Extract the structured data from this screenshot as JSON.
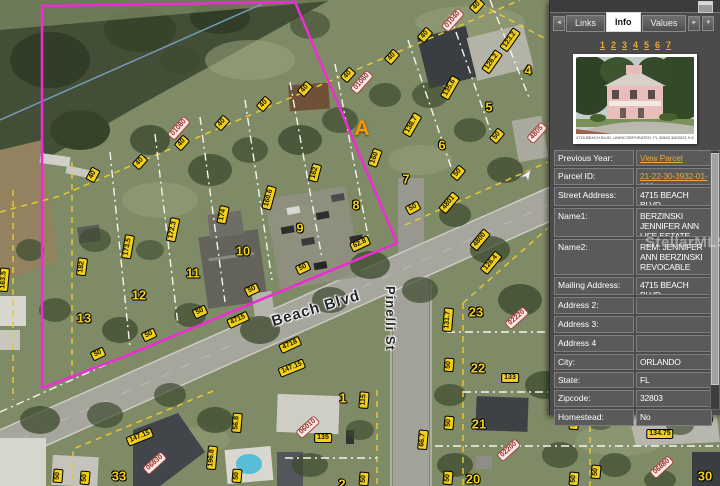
{
  "panel": {
    "tabs": {
      "prev_label": "◄",
      "items": [
        {
          "label": "Links",
          "active": false
        },
        {
          "label": "Info",
          "active": true
        },
        {
          "label": "Values",
          "active": false
        }
      ],
      "next_label": "►",
      "more_label": "▼"
    },
    "pagination": [
      "1",
      "2",
      "3",
      "4",
      "5",
      "6",
      "7"
    ],
    "photo_caption": "4715 BEACH BLVD, UNINCORPORATED, FL 32803   3/8/2021 9:28 AM",
    "fields": [
      {
        "label": "Previous Year:",
        "value": "View Parcel Record",
        "link": true,
        "h": 16
      },
      {
        "label": "Parcel ID:",
        "value": "21-22-30-3932-01-080",
        "link": true,
        "h": 17
      },
      {
        "label": "Street Address:",
        "value": "4715 BEACH BLVD",
        "link": false,
        "h": 19
      },
      {
        "label": "Name1:",
        "value": "BERZINSKI JENNIFER ANN LIFE ESTATE",
        "link": false,
        "h": 29
      },
      {
        "label": "Name2:",
        "value": "REM: JENNIFER ANN BERZINSKI REVOCABLE TRUST",
        "link": false,
        "h": 36
      },
      {
        "label": "Mailing Address:",
        "value": "4715 BEACH BLVD",
        "link": false,
        "h": 18
      },
      {
        "label": "Address 2:",
        "value": "",
        "link": false,
        "h": 17
      },
      {
        "label": "Address 3:",
        "value": "",
        "link": false,
        "h": 17
      },
      {
        "label": "Address 4",
        "value": "",
        "link": false,
        "h": 17
      },
      {
        "label": "City:",
        "value": "ORLANDO",
        "link": false,
        "h": 16
      },
      {
        "label": "State:",
        "value": "FL",
        "link": false,
        "h": 16
      },
      {
        "label": "Zipcode:",
        "value": "32803",
        "link": false,
        "h": 17
      },
      {
        "label": "Homestead:",
        "value": "No",
        "link": false,
        "h": 17
      }
    ]
  },
  "map": {
    "marker": "A",
    "watermark": "StellarMLS",
    "streets": [
      {
        "name": "Beach Blvd"
      },
      {
        "name": "Pinelli St"
      }
    ],
    "colors": {
      "selection": "#ee2bd4",
      "dimension_label": "#f2d018",
      "address_label": "#ffe9e6",
      "link_accent": "#e8a838"
    },
    "parcel_numbers": [
      {
        "t": "1",
        "x": 343,
        "y": 398
      },
      {
        "t": "2",
        "x": 342,
        "y": 484
      },
      {
        "t": "4",
        "x": 528,
        "y": 70
      },
      {
        "t": "5",
        "x": 489,
        "y": 107
      },
      {
        "t": "6",
        "x": 442,
        "y": 145
      },
      {
        "t": "7",
        "x": 406,
        "y": 179
      },
      {
        "t": "8",
        "x": 356,
        "y": 205
      },
      {
        "t": "9",
        "x": 300,
        "y": 228
      },
      {
        "t": "10",
        "x": 243,
        "y": 251
      },
      {
        "t": "11",
        "x": 193,
        "y": 273
      },
      {
        "t": "12",
        "x": 139,
        "y": 295
      },
      {
        "t": "13",
        "x": 84,
        "y": 318
      },
      {
        "t": "20",
        "x": 473,
        "y": 479
      },
      {
        "t": "21",
        "x": 479,
        "y": 424
      },
      {
        "t": "22",
        "x": 478,
        "y": 368
      },
      {
        "t": "23",
        "x": 476,
        "y": 312
      },
      {
        "t": "29",
        "x": 705,
        "y": 419
      },
      {
        "t": "30",
        "x": 705,
        "y": 476
      },
      {
        "t": "33",
        "x": 119,
        "y": 476
      }
    ],
    "dim_labels": [
      {
        "t": "40",
        "x": 93,
        "y": 175,
        "r": -62
      },
      {
        "t": "40",
        "x": 140,
        "y": 162,
        "r": -48
      },
      {
        "t": "40",
        "x": 182,
        "y": 143,
        "r": -48
      },
      {
        "t": "40",
        "x": 222,
        "y": 123,
        "r": -48
      },
      {
        "t": "40",
        "x": 264,
        "y": 104,
        "r": -48
      },
      {
        "t": "40",
        "x": 305,
        "y": 89,
        "r": -48
      },
      {
        "t": "40",
        "x": 348,
        "y": 75,
        "r": -48
      },
      {
        "t": "40",
        "x": 392,
        "y": 57,
        "r": -48
      },
      {
        "t": "40",
        "x": 425,
        "y": 35,
        "r": -48
      },
      {
        "t": "40",
        "x": 477,
        "y": 6,
        "r": -48
      },
      {
        "t": "163.5",
        "x": 4,
        "y": 280,
        "r": -85
      },
      {
        "t": "182",
        "x": 82,
        "y": 267,
        "r": -83
      },
      {
        "t": "173.5",
        "x": 128,
        "y": 247,
        "r": -80
      },
      {
        "t": "172.3",
        "x": 173,
        "y": 230,
        "r": -78
      },
      {
        "t": "174",
        "x": 223,
        "y": 215,
        "r": -78
      },
      {
        "t": "160.6",
        "x": 269,
        "y": 198,
        "r": -75
      },
      {
        "t": "162",
        "x": 315,
        "y": 173,
        "r": -75
      },
      {
        "t": "160",
        "x": 375,
        "y": 158,
        "r": -70
      },
      {
        "t": "123.2",
        "x": 510,
        "y": 40,
        "r": -55
      },
      {
        "t": "126.2",
        "x": 492,
        "y": 62,
        "r": -55
      },
      {
        "t": "135.6",
        "x": 450,
        "y": 88,
        "r": -60
      },
      {
        "t": "138.7",
        "x": 412,
        "y": 125,
        "r": -60
      },
      {
        "t": "50",
        "x": 98,
        "y": 354,
        "r": -25
      },
      {
        "t": "50",
        "x": 149,
        "y": 335,
        "r": -25
      },
      {
        "t": "50",
        "x": 200,
        "y": 312,
        "r": -25
      },
      {
        "t": "50",
        "x": 252,
        "y": 290,
        "r": -25
      },
      {
        "t": "50",
        "x": 303,
        "y": 268,
        "r": -25
      },
      {
        "t": "62.8",
        "x": 360,
        "y": 244,
        "r": -25
      },
      {
        "t": "50",
        "x": 413,
        "y": 208,
        "r": -28
      },
      {
        "t": "50",
        "x": 458,
        "y": 173,
        "r": -50
      },
      {
        "t": "50",
        "x": 497,
        "y": 136,
        "r": -50
      },
      {
        "t": "4715",
        "x": 238,
        "y": 320,
        "r": -25
      },
      {
        "t": "4718",
        "x": 290,
        "y": 345,
        "r": -25
      },
      {
        "t": "147.15",
        "x": 292,
        "y": 368,
        "r": -22
      },
      {
        "t": "147.15",
        "x": 140,
        "y": 437,
        "r": -22
      },
      {
        "t": "4801",
        "x": 449,
        "y": 203,
        "r": -50
      },
      {
        "t": "4800",
        "x": 480,
        "y": 240,
        "r": -50
      },
      {
        "t": "126.4",
        "x": 491,
        "y": 263,
        "r": -50
      },
      {
        "t": "131.7",
        "x": 448,
        "y": 320,
        "r": -85
      },
      {
        "t": "115",
        "x": 364,
        "y": 400,
        "r": -85
      },
      {
        "t": "135",
        "x": 323,
        "y": 438,
        "r": 0
      },
      {
        "t": "133",
        "x": 510,
        "y": 378,
        "r": 0
      },
      {
        "t": "134.75",
        "x": 660,
        "y": 434,
        "r": 0
      },
      {
        "t": "66.7",
        "x": 423,
        "y": 440,
        "r": -85
      },
      {
        "t": "50",
        "x": 364,
        "y": 479,
        "r": -85
      },
      {
        "t": "50",
        "x": 449,
        "y": 423,
        "r": -85
      },
      {
        "t": "50",
        "x": 448,
        "y": 478,
        "r": -85
      },
      {
        "t": "50",
        "x": 449,
        "y": 365,
        "r": -85
      },
      {
        "t": "50",
        "x": 58,
        "y": 476,
        "r": -85
      },
      {
        "t": "50",
        "x": 85,
        "y": 478,
        "r": -85
      },
      {
        "t": "56.8",
        "x": 237,
        "y": 423,
        "r": -85
      },
      {
        "t": "196.8",
        "x": 212,
        "y": 458,
        "r": -85
      },
      {
        "t": "50",
        "x": 237,
        "y": 476,
        "r": -85
      },
      {
        "t": "50",
        "x": 574,
        "y": 423,
        "r": -85
      },
      {
        "t": "50",
        "x": 596,
        "y": 472,
        "r": -85
      },
      {
        "t": "50",
        "x": 574,
        "y": 479,
        "r": -85
      }
    ],
    "address_labels": [
      {
        "t": "01080",
        "x": 179,
        "y": 128,
        "r": -48
      },
      {
        "t": "01060",
        "x": 362,
        "y": 82,
        "r": -48
      },
      {
        "t": "01040",
        "x": 453,
        "y": 20,
        "r": -48
      },
      {
        "t": "4805",
        "x": 537,
        "y": 133,
        "r": -48
      },
      {
        "t": "02220",
        "x": 517,
        "y": 318,
        "r": -42
      },
      {
        "t": "02200",
        "x": 509,
        "y": 450,
        "r": -42
      },
      {
        "t": "06010",
        "x": 308,
        "y": 427,
        "r": -42
      },
      {
        "t": "06830",
        "x": 155,
        "y": 463,
        "r": -42
      },
      {
        "t": "06880",
        "x": 662,
        "y": 467,
        "r": -42
      }
    ]
  }
}
